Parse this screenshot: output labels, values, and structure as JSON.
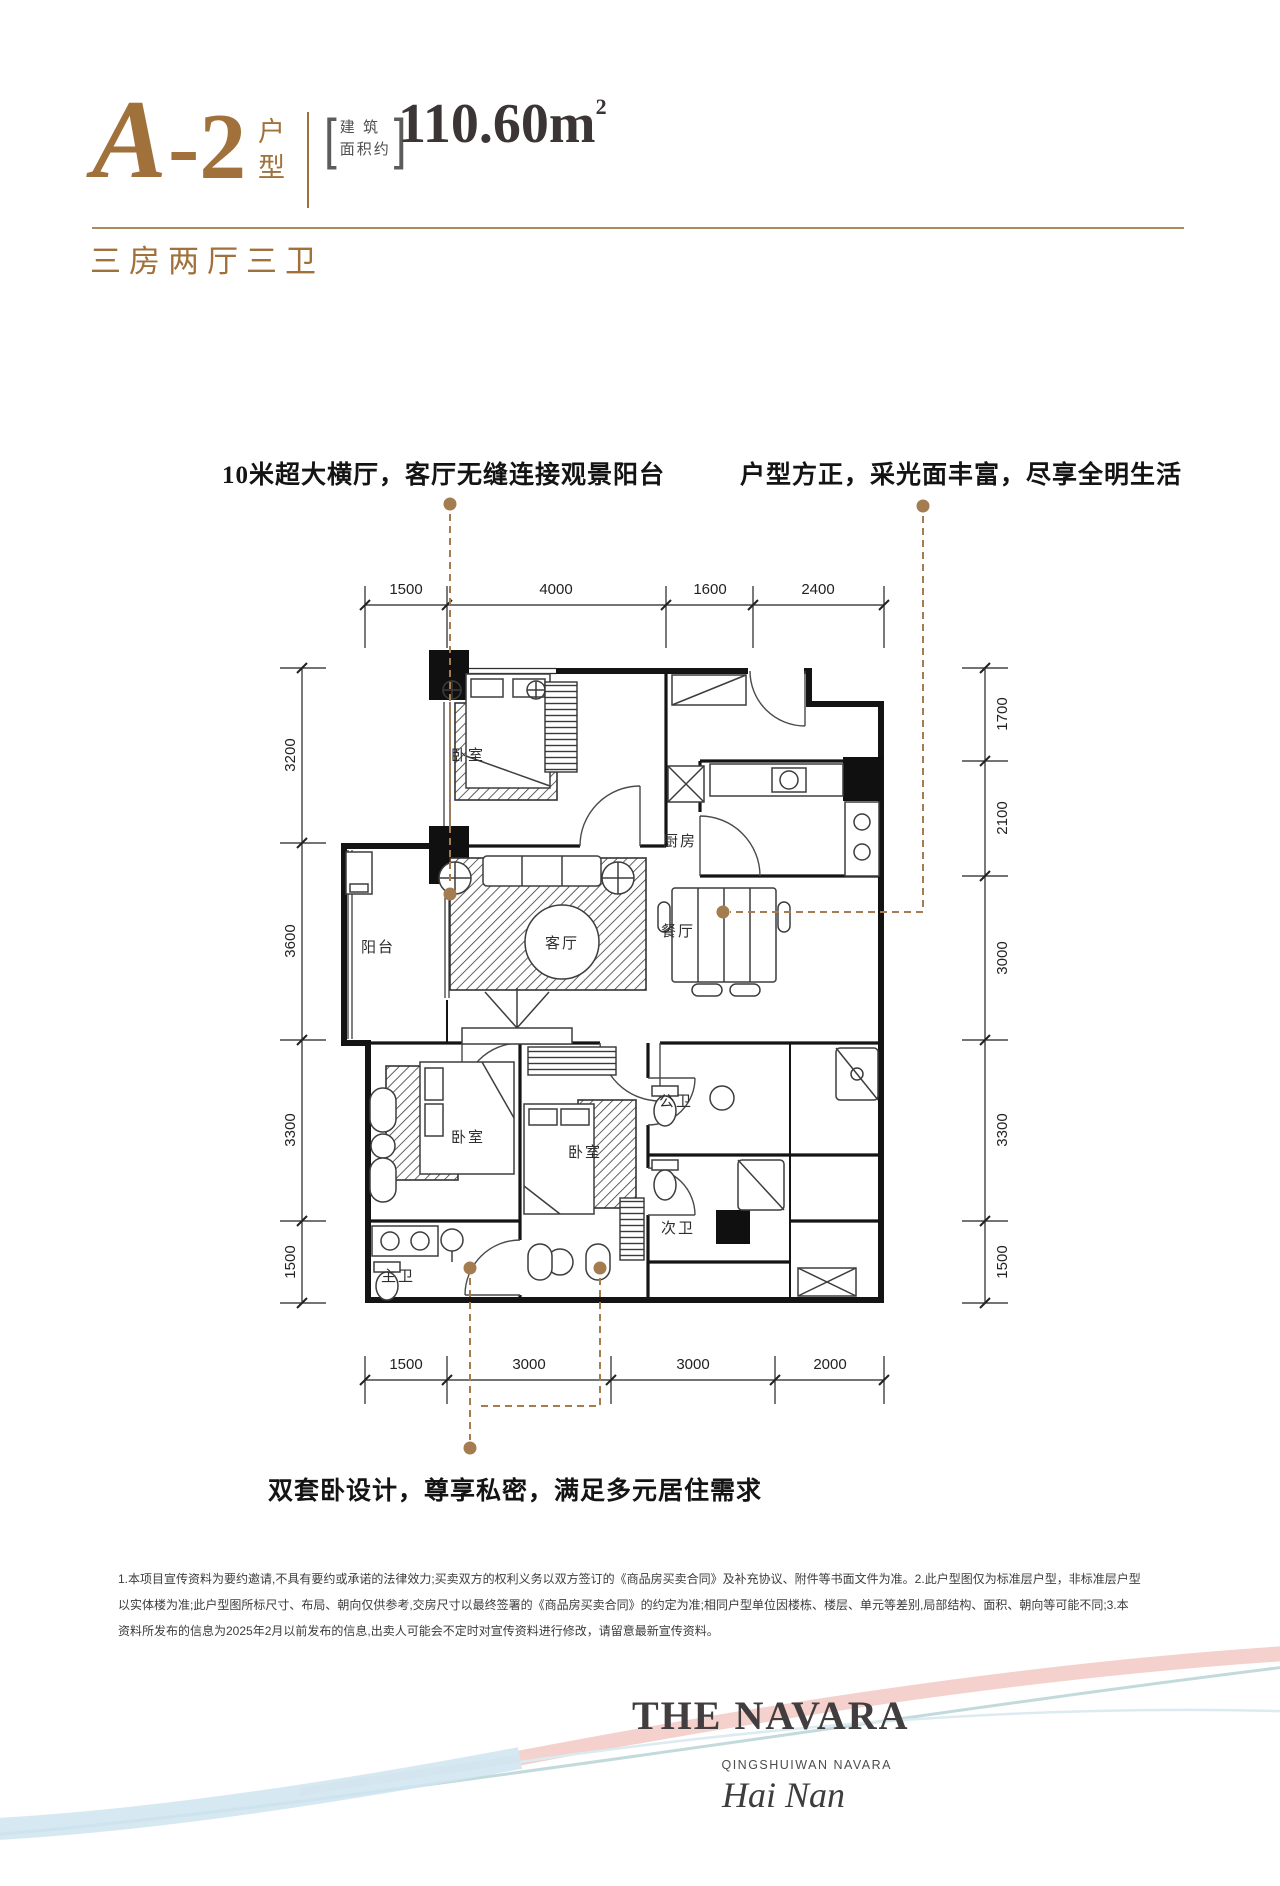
{
  "header": {
    "code": "A",
    "code_suffix": "-2",
    "code_label_top": "户",
    "code_label_bottom": "型",
    "area_prefix_line1": "建 筑",
    "area_prefix_line2": "面积约",
    "area_value": "110.60m",
    "area_sup": "2",
    "subtitle": "三房两厅三卫",
    "accent_color": "#A1713C"
  },
  "annotations": {
    "top_left": "10米超大横厅，客厅无缝连接观景阳台",
    "top_right": "户型方正，采光面丰富，尽享全明生活",
    "bottom": "双套卧设计，尊享私密，满足多元居住需求"
  },
  "plan": {
    "colors": {
      "wall": "#141414",
      "callout": "#A57C50",
      "dimension": "#222222"
    },
    "dims_top": [
      "1500",
      "4000",
      "1600",
      "2400"
    ],
    "dims_bottom": [
      "1500",
      "3000",
      "3000",
      "2000"
    ],
    "dims_left": [
      "3200",
      "3600",
      "3300",
      "1500"
    ],
    "dims_right": [
      "1700",
      "2100",
      "3000",
      "3300",
      "1500"
    ],
    "rooms": [
      {
        "id": "bedroom-top",
        "label": "卧室"
      },
      {
        "id": "kitchen",
        "label": "厨房"
      },
      {
        "id": "balcony",
        "label": "阳台"
      },
      {
        "id": "living",
        "label": "客厅"
      },
      {
        "id": "dining",
        "label": "餐厅"
      },
      {
        "id": "bedroom-left",
        "label": "卧室"
      },
      {
        "id": "bedroom-right",
        "label": "卧室"
      },
      {
        "id": "bath-public",
        "label": "公卫"
      },
      {
        "id": "bath-secondary",
        "label": "次卫"
      },
      {
        "id": "bath-master",
        "label": "主卫"
      }
    ]
  },
  "disclaimer": {
    "lines": [
      "1.本项目宣传资料为要约邀请,不具有要约或承诺的法律效力;买卖双方的权利义务以双方签订的《商品房买卖合同》及补充协议、附件等书面文件为准。2.此户型图仅为标准层户型，非标准层户型",
      "以实体楼为准;此户型图所标尺寸、布局、朝向仅供参考,交房尺寸以最终签署的《商品房买卖合同》的约定为准;相同户型单位因楼栋、楼层、单元等差别,局部结构、面积、朝向等可能不同;3.本",
      "资料所发布的信息为2025年2月以前发布的信息,出卖人可能会不定时对宣传资料进行修改，请留意最新宣传资料。"
    ]
  },
  "footer": {
    "brand": "THE NAVARA",
    "sub_brand": "QINGSHUIWAN NAVARA",
    "location": "Hai Nan",
    "brand_color": "#423d3e"
  }
}
